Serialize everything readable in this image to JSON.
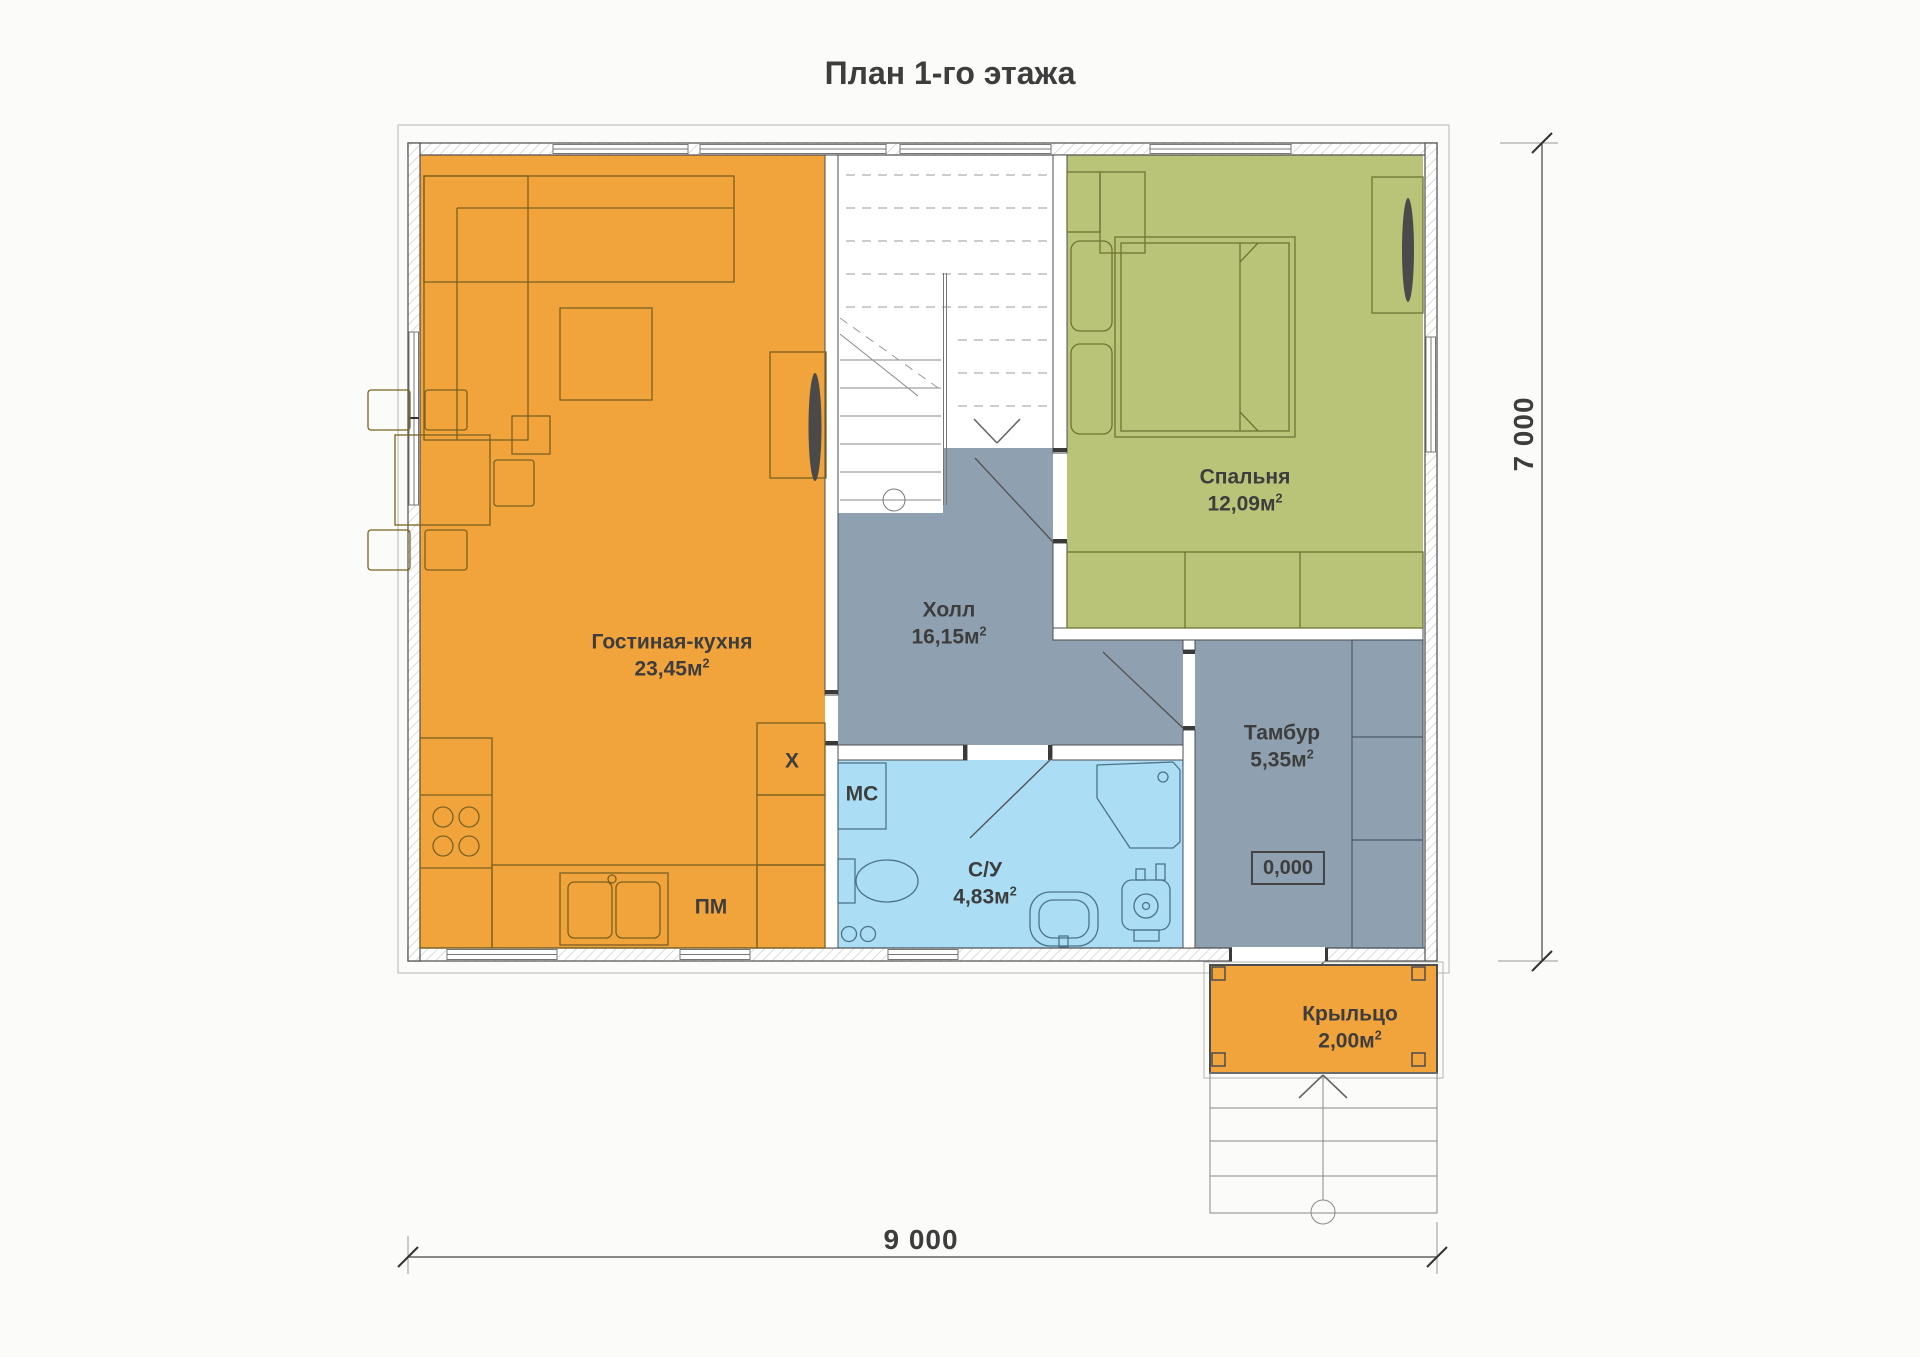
{
  "title": "План 1-го этажа",
  "rooms": {
    "living_kitchen": {
      "name": "Гостиная-кухня",
      "area": "23,45м",
      "sup": "2"
    },
    "hall": {
      "name": "Холл",
      "area": "16,15м",
      "sup": "2"
    },
    "bedroom": {
      "name": "Спальня",
      "area": "12,09м",
      "sup": "2"
    },
    "bathroom": {
      "name": "С/У",
      "area": "4,83м",
      "sup": "2"
    },
    "vestibule": {
      "name": "Тамбур",
      "area": "5,35м",
      "sup": "2"
    },
    "porch": {
      "name": "Крыльцо",
      "area": "2,00м",
      "sup": "2"
    }
  },
  "appliances": {
    "fridge": "X",
    "washing_machine": "МС",
    "dishwasher": "ПМ"
  },
  "level_mark": "0,000",
  "dimensions": {
    "width": "9 000",
    "depth": "7 000"
  },
  "colors": {
    "orange": "#F1A33C",
    "green": "#B9C478",
    "hall": "#8FA1B1",
    "bath": "#ABDDF5",
    "wall": "#4D4D4D",
    "text": "#3D3D3D"
  }
}
